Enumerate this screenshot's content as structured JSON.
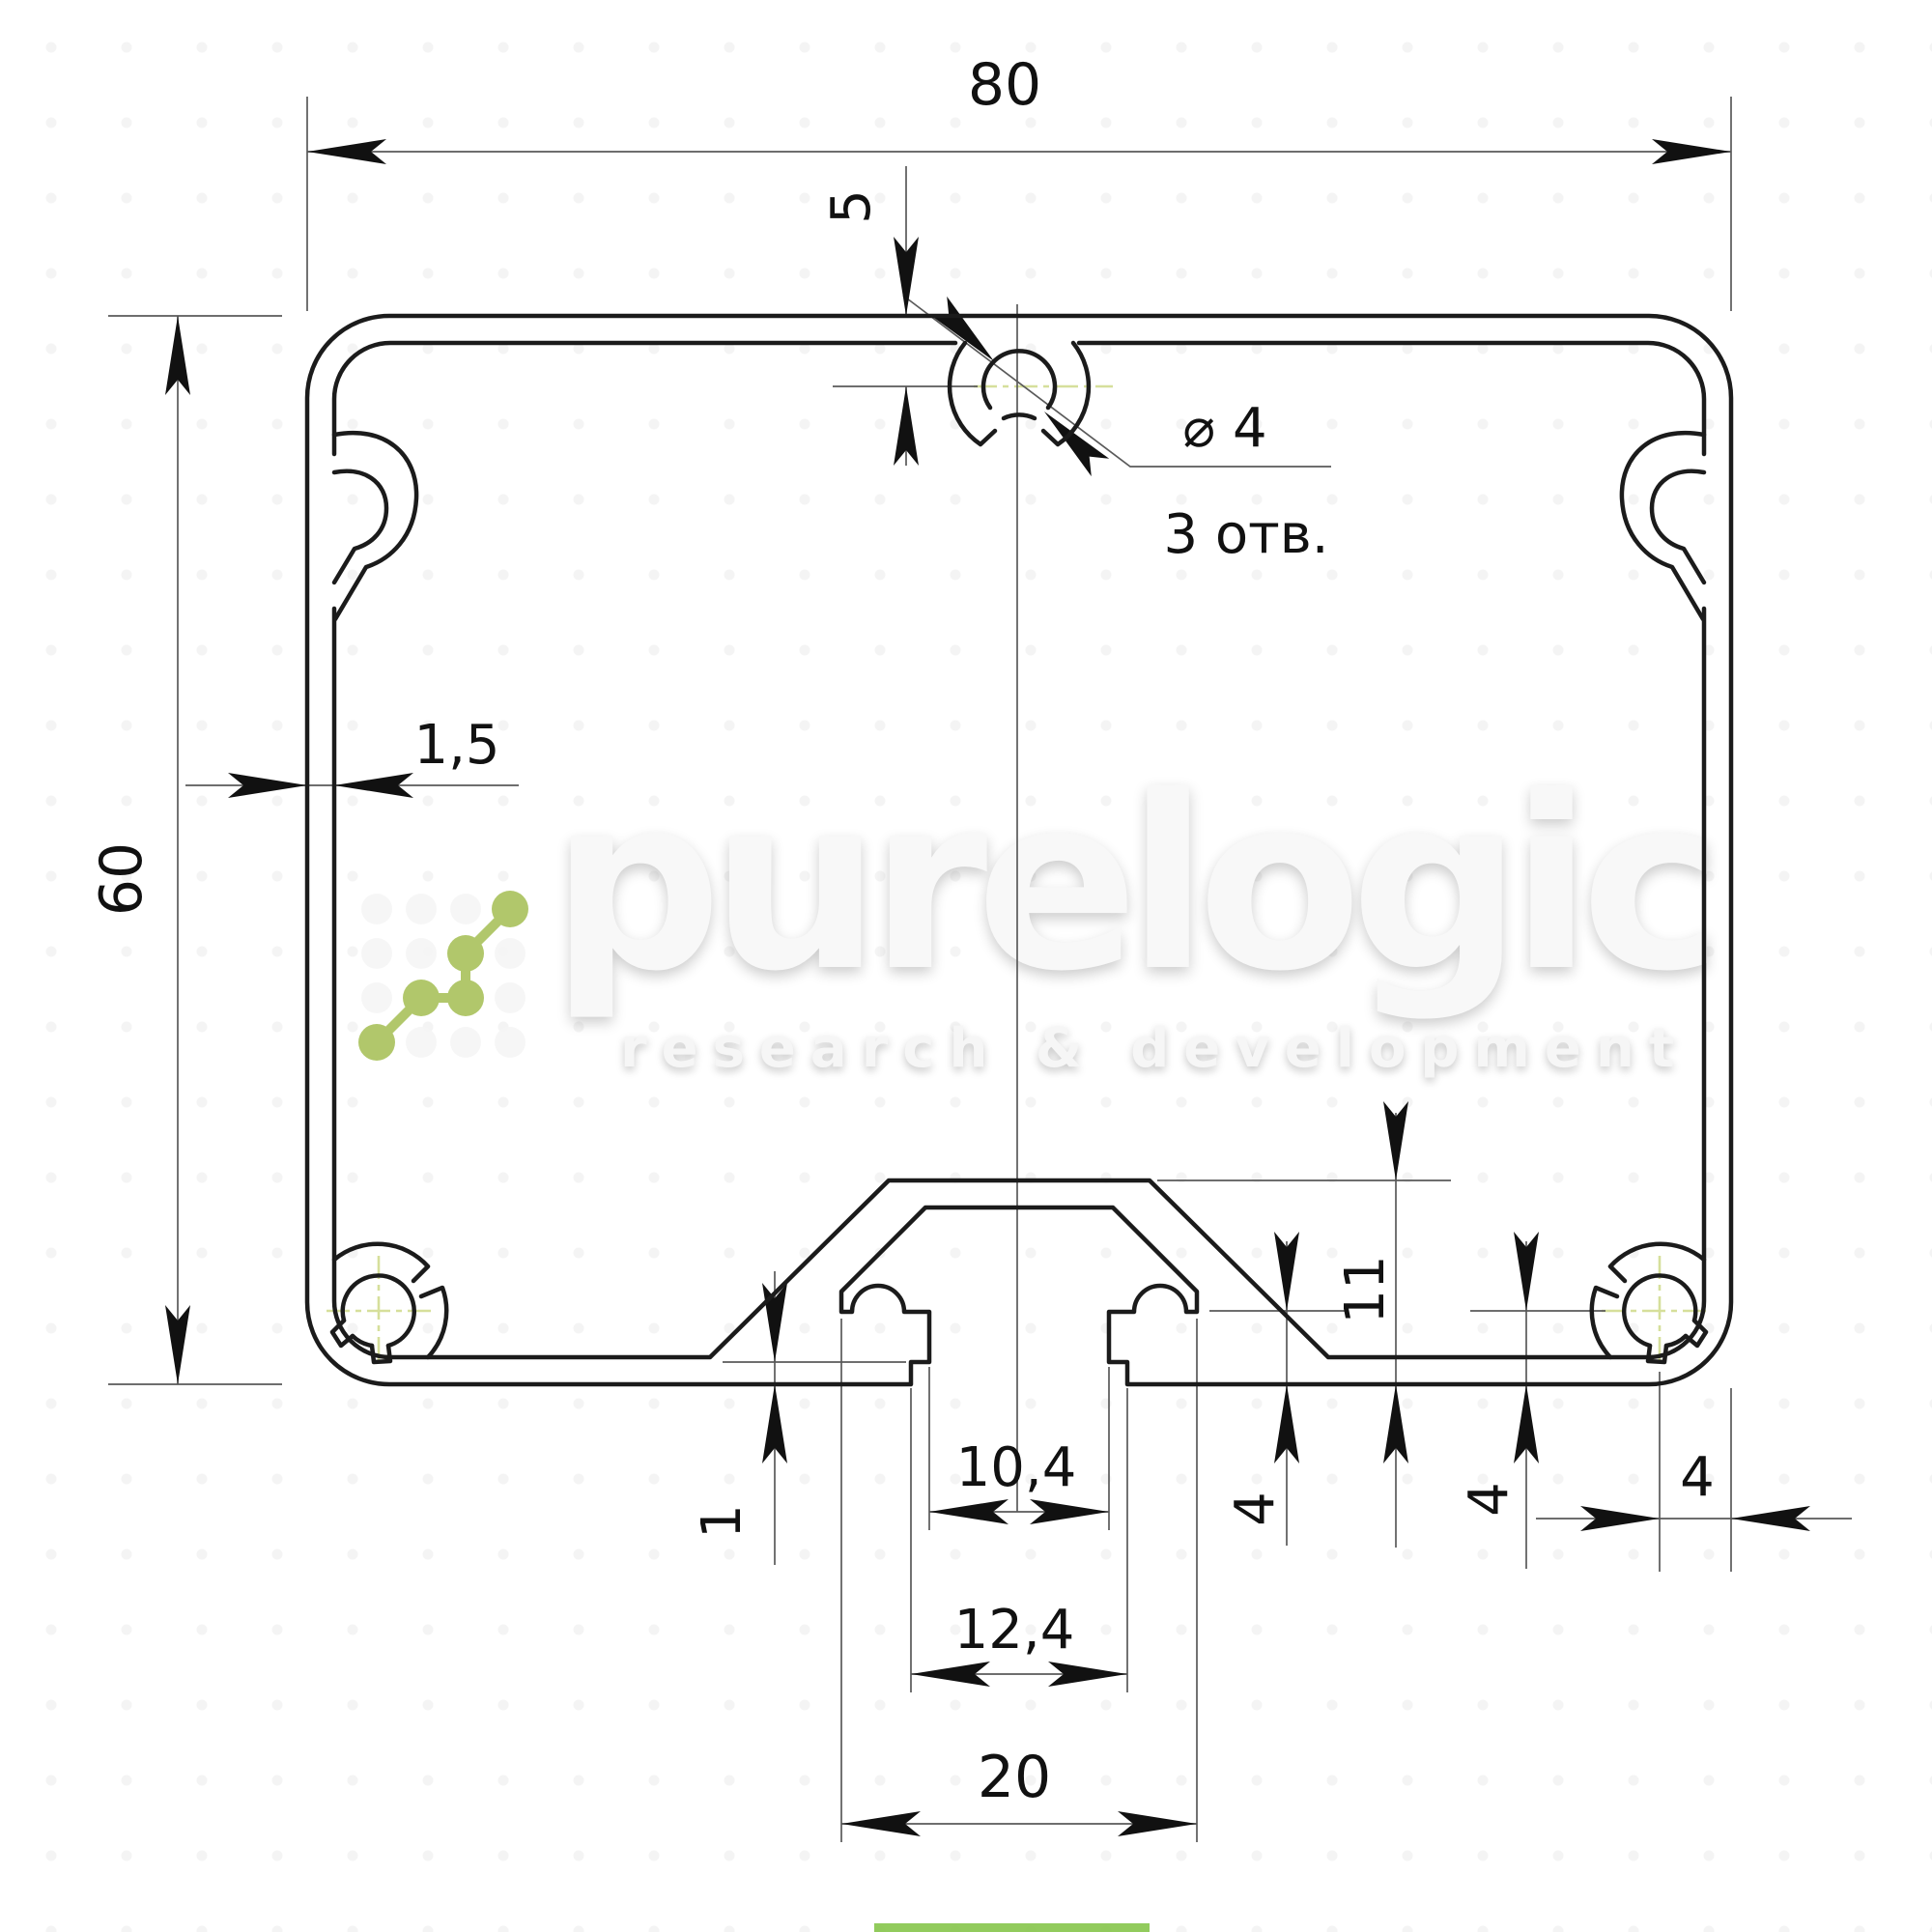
{
  "drawing": {
    "type": "profile-cross-section",
    "units": "mm",
    "watermark": {
      "brand": "purelogic",
      "tagline": "research & development"
    },
    "labels": {
      "overall_width": "80",
      "overall_height": "60",
      "top_hole_offset": "5",
      "hole_diameter": "⌀ 4",
      "hole_count_note": "3 отв.",
      "wall_thickness": "1,5",
      "slot_boss_height": "11",
      "lip_step": "1",
      "slot_opening_width": "10,4",
      "slot_recess_width": "12,4",
      "slot_cavity_width": "20",
      "corner_hole_offset_mid": "4",
      "corner_hole_offset_right_v": "4",
      "corner_hole_offset_right_h": "4"
    },
    "colors": {
      "contour": "#1b1b1b",
      "dimension": "#5a5a5a",
      "centerline": "#d6df9b",
      "logo_green": "#a9c25c",
      "watermark": "#f8f8f8",
      "accent_bar": "#7fc241"
    }
  }
}
